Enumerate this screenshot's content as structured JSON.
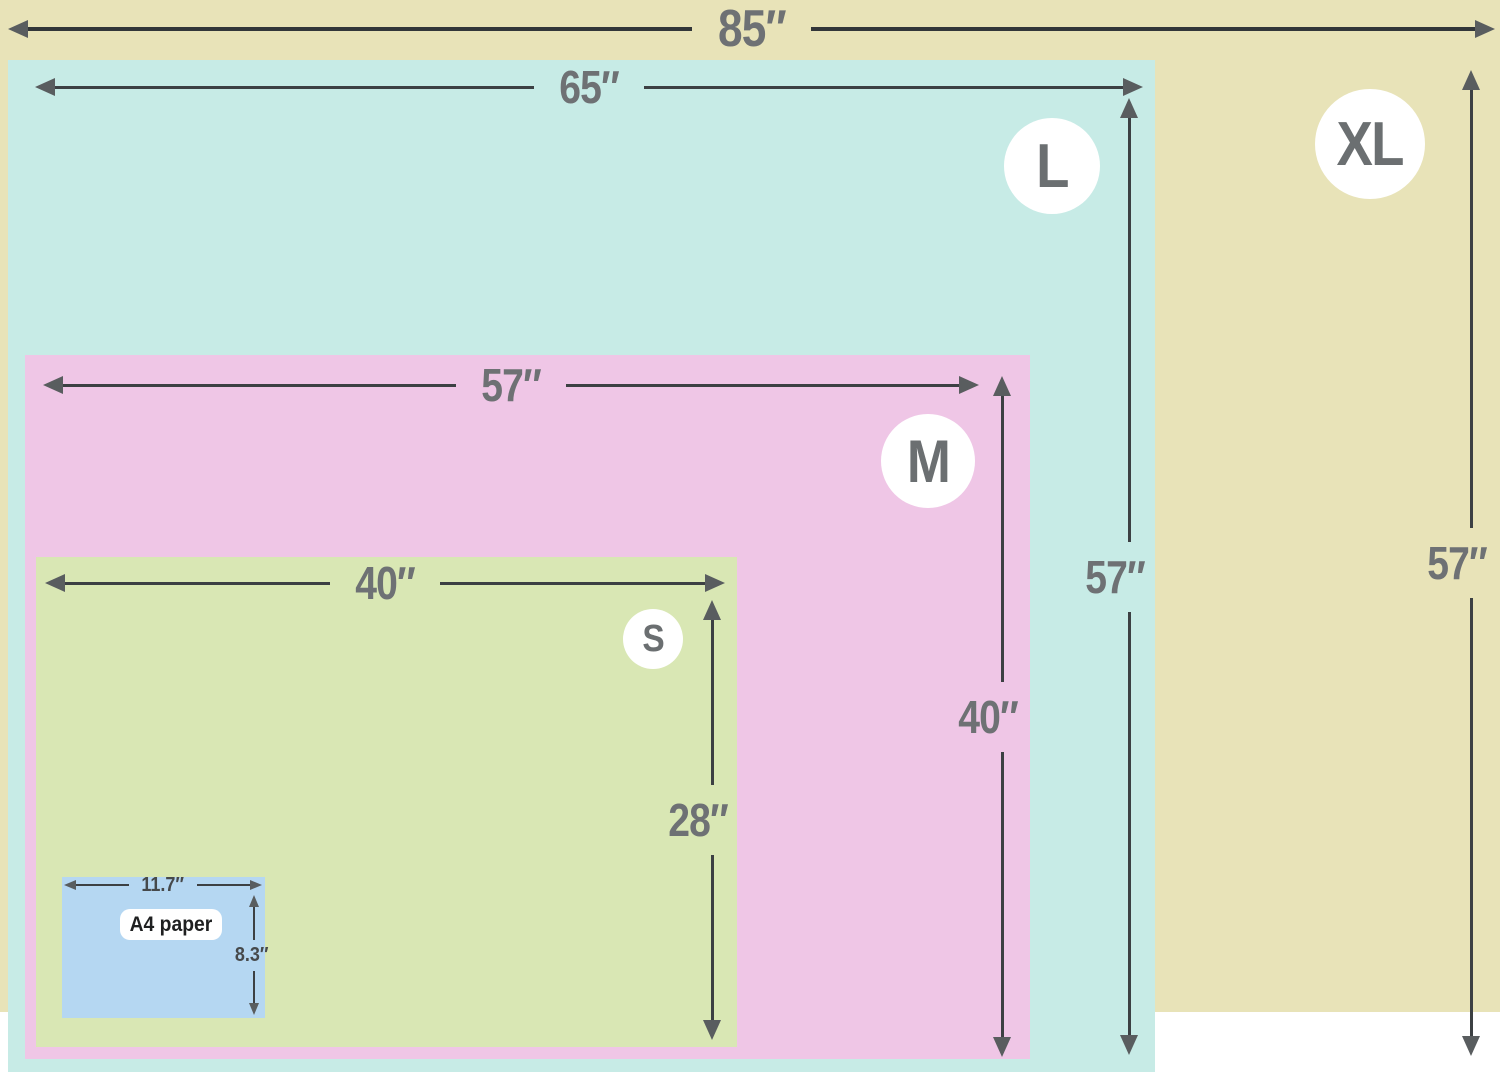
{
  "diagram_title": "Blanket / throw size comparison with A4 paper reference",
  "sizes": {
    "xl": {
      "badge": "XL",
      "width": "85″",
      "height": "57″",
      "color": "#e8e3b8"
    },
    "l": {
      "badge": "L",
      "width": "65″",
      "height": "57″",
      "color": "#c7ebe6"
    },
    "m": {
      "badge": "M",
      "width": "57″",
      "height": "40″",
      "color": "#efc6e6"
    },
    "s": {
      "badge": "S",
      "width": "40″",
      "height": "28″",
      "color": "#d9e7b4"
    },
    "a4": {
      "label": "A4 paper",
      "width": "11.7″",
      "height": "8.3″",
      "color": "#b5d7f2"
    }
  },
  "colors": {
    "arrow_line": "#3c4043",
    "arrow_head": "#595d5f",
    "dimension_text": "#6e7174",
    "small_dimension_text": "#46494b",
    "badge_background": "#ffffff",
    "badge_text": "#6b6f71",
    "a4_pill_background": "#ffffff",
    "a4_pill_text": "#1f2021"
  }
}
